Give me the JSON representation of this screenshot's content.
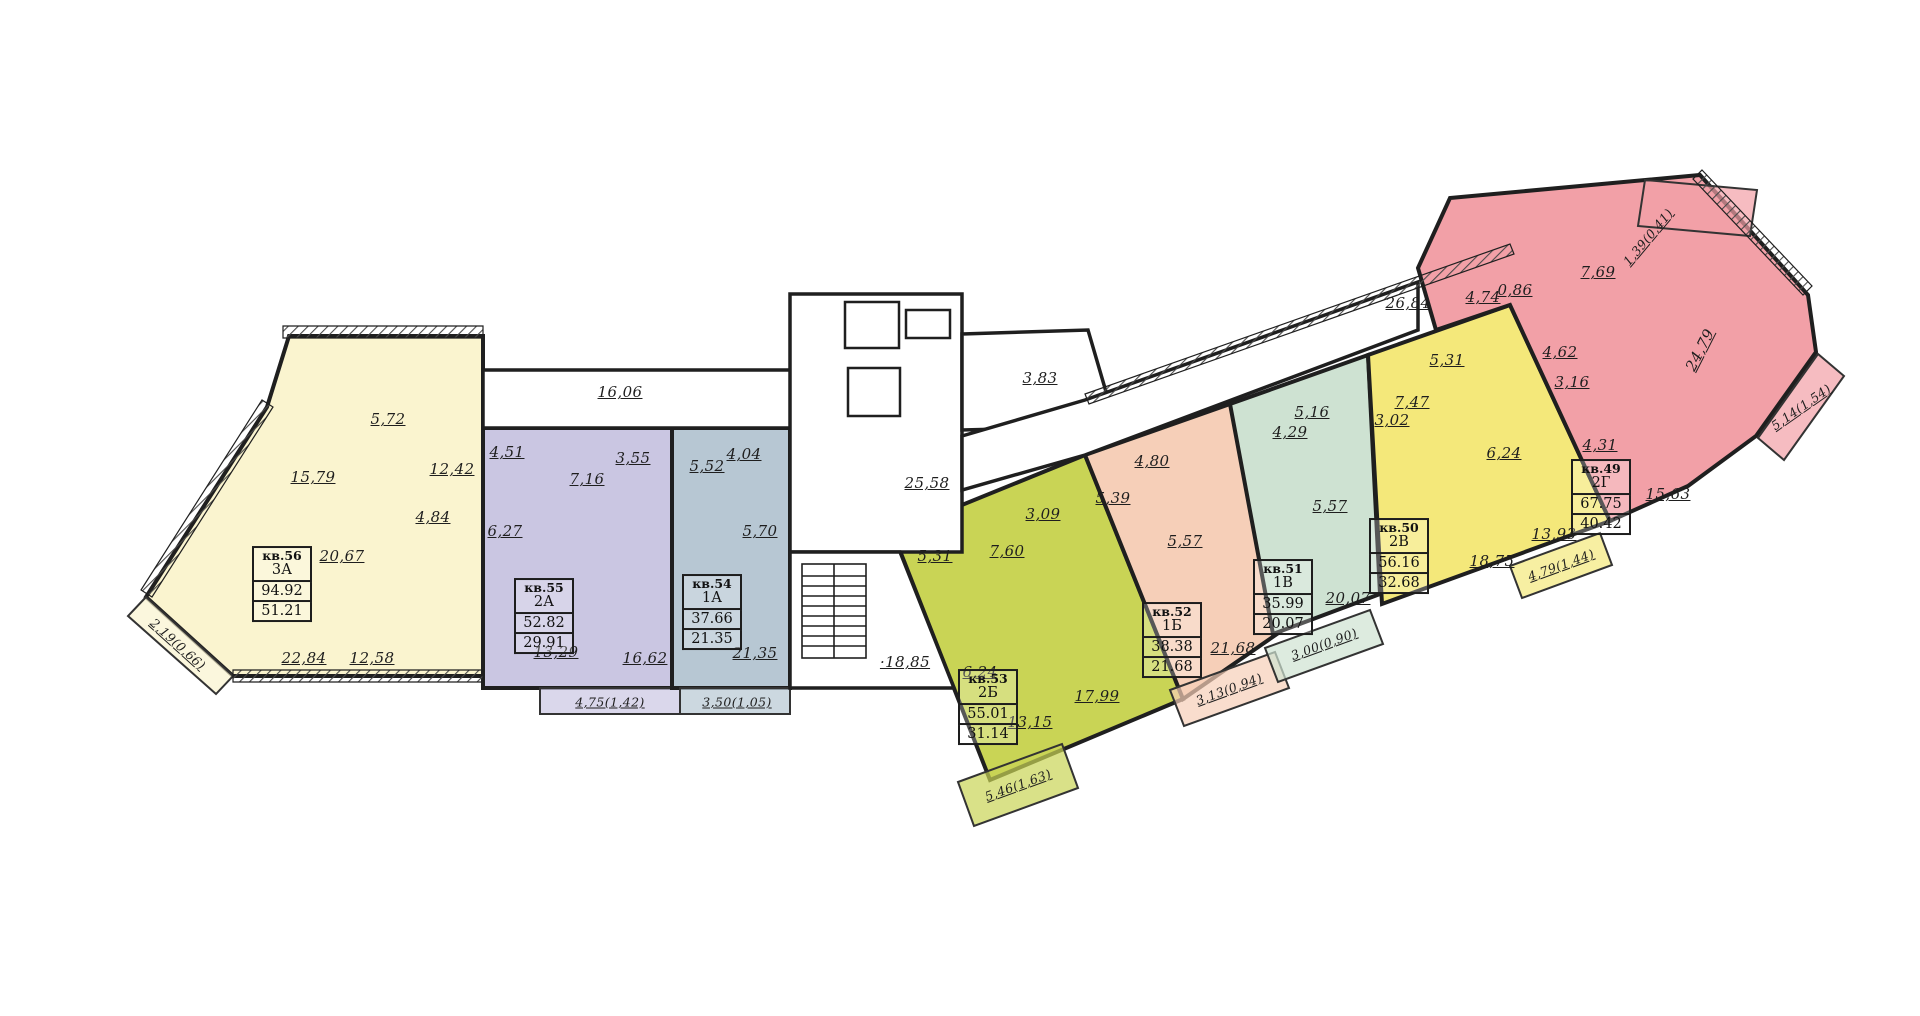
{
  "canvas": {
    "width": 1920,
    "height": 1016,
    "background": "#ffffff",
    "wall_color": "#1f1f1f",
    "hatch_color": "#4a4a4a"
  },
  "apartments": [
    {
      "id": "56",
      "number": "кв.56",
      "type": "3А",
      "total_area": "94.92",
      "living_area": "51.21",
      "color": "#faf4cf",
      "polygon": "289,336 483,336 483,676 233,676 146,597 267,407",
      "info_box": {
        "x": 282,
        "y": 584
      },
      "rooms": [
        {
          "label": "15,79",
          "x": 313,
          "y": 477
        },
        {
          "label": "5,72",
          "x": 388,
          "y": 419
        },
        {
          "label": "12,42",
          "x": 452,
          "y": 469
        },
        {
          "label": "4,84",
          "x": 433,
          "y": 517
        },
        {
          "label": "20,67",
          "x": 342,
          "y": 556
        },
        {
          "label": "22,84",
          "x": 304,
          "y": 658
        },
        {
          "label": "12,58",
          "x": 372,
          "y": 658
        }
      ],
      "balconies": [
        {
          "label": "2,19(0,66)",
          "x": 178,
          "y": 644,
          "rotate": 42
        }
      ],
      "balcony_polys": [
        "146,597 128,616 216,694 233,676"
      ]
    },
    {
      "id": "55",
      "number": "кв.55",
      "type": "2А",
      "total_area": "52.82",
      "living_area": "29.91",
      "color": "#cac6e2",
      "polygon": "483,428 672,428 672,688 483,688",
      "info_box": {
        "x": 544,
        "y": 616
      },
      "rooms": [
        {
          "label": "4,51",
          "x": 507,
          "y": 452
        },
        {
          "label": "7,16",
          "x": 587,
          "y": 479
        },
        {
          "label": "3,55",
          "x": 633,
          "y": 458
        },
        {
          "label": "6,27",
          "x": 505,
          "y": 531
        },
        {
          "label": "13,29",
          "x": 556,
          "y": 652
        },
        {
          "label": "16,62",
          "x": 645,
          "y": 658
        }
      ],
      "balconies": [
        {
          "label": "4,75(1,42)",
          "x": 610,
          "y": 702
        }
      ],
      "balcony_polys": [
        "540,688 680,688 680,714 540,714"
      ]
    },
    {
      "id": "54",
      "number": "кв.54",
      "type": "1А",
      "total_area": "37.66",
      "living_area": "21.35",
      "color": "#b7c7d3",
      "polygon": "672,428 790,428 790,688 672,688",
      "info_box": {
        "x": 712,
        "y": 612
      },
      "rooms": [
        {
          "label": "5,52",
          "x": 707,
          "y": 466
        },
        {
          "label": "4,04",
          "x": 744,
          "y": 454
        },
        {
          "label": "5,70",
          "x": 760,
          "y": 531
        },
        {
          "label": "21,35",
          "x": 755,
          "y": 653
        }
      ],
      "balconies": [
        {
          "label": "3,50(1,05)",
          "x": 737,
          "y": 702
        }
      ],
      "balcony_polys": [
        "680,688 790,688 790,714 680,714"
      ]
    },
    {
      "id": "53",
      "number": "кв.53",
      "type": "2Б",
      "total_area": "55.01",
      "living_area": "31.14",
      "color": "#c9d455",
      "polygon": "893,533 1085,455 1183,699 990,780",
      "info_box": {
        "x": 988,
        "y": 707
      },
      "rooms": [
        {
          "label": "5,31",
          "x": 935,
          "y": 556
        },
        {
          "label": "7,60",
          "x": 1007,
          "y": 551
        },
        {
          "label": "3,09",
          "x": 1043,
          "y": 514
        },
        {
          "label": "6,24",
          "x": 980,
          "y": 672
        },
        {
          "label": "13,15",
          "x": 1030,
          "y": 722
        },
        {
          "label": "17,99",
          "x": 1097,
          "y": 696
        }
      ],
      "balconies": [
        {
          "label": "5,46(1,63)",
          "x": 1018,
          "y": 785,
          "rotate": -20
        }
      ],
      "balcony_polys": [
        "958,782 1062,744 1078,788 974,826"
      ]
    },
    {
      "id": "52",
      "number": "кв.52",
      "type": "1Б",
      "total_area": "38.38",
      "living_area": "21.68",
      "color": "#f6cfb8",
      "polygon": "1085,455 1230,404 1290,625 1183,699",
      "info_box": {
        "x": 1172,
        "y": 640
      },
      "rooms": [
        {
          "label": "4,80",
          "x": 1152,
          "y": 461
        },
        {
          "label": "5,39",
          "x": 1113,
          "y": 498
        },
        {
          "label": "5,57",
          "x": 1185,
          "y": 541
        },
        {
          "label": "21,68",
          "x": 1233,
          "y": 648
        }
      ],
      "balconies": [
        {
          "label": "3,13(0,94)",
          "x": 1229,
          "y": 689,
          "rotate": -20
        }
      ],
      "balcony_polys": [
        "1170,690 1275,652 1289,688 1184,726"
      ]
    },
    {
      "id": "51",
      "number": "кв.51",
      "type": "1В",
      "total_area": "35.99",
      "living_area": "20.07",
      "color": "#cee2d2",
      "polygon": "1230,404 1368,355 1380,594 1273,634",
      "info_box": {
        "x": 1283,
        "y": 597
      },
      "rooms": [
        {
          "label": "4,29",
          "x": 1290,
          "y": 432
        },
        {
          "label": "5,16",
          "x": 1312,
          "y": 412
        },
        {
          "label": "5,57",
          "x": 1330,
          "y": 506
        },
        {
          "label": "20,07",
          "x": 1348,
          "y": 598
        }
      ],
      "balconies": [
        {
          "label": "3,00(0,90)",
          "x": 1324,
          "y": 644,
          "rotate": -20
        }
      ],
      "balcony_polys": [
        "1265,648 1370,610 1383,644 1278,682"
      ]
    },
    {
      "id": "50",
      "number": "кв.50",
      "type": "2В",
      "total_area": "56.16",
      "living_area": "32.68",
      "color": "#f4e87a",
      "polygon": "1368,355 1510,305 1610,521 1382,604",
      "info_box": {
        "x": 1399,
        "y": 556
      },
      "rooms": [
        {
          "label": "5,31",
          "x": 1447,
          "y": 360
        },
        {
          "label": "7,47",
          "x": 1412,
          "y": 402
        },
        {
          "label": "3,02",
          "x": 1392,
          "y": 420
        },
        {
          "label": "6,24",
          "x": 1504,
          "y": 453
        },
        {
          "label": "18,75",
          "x": 1492,
          "y": 561
        },
        {
          "label": "13,93",
          "x": 1554,
          "y": 534
        }
      ],
      "balconies": [
        {
          "label": "4,79(1,44)",
          "x": 1561,
          "y": 565,
          "rotate": -20
        }
      ],
      "balcony_polys": [
        "1510,566 1600,533 1612,565 1522,598"
      ]
    },
    {
      "id": "49",
      "number": "кв.49",
      "type": "2Г",
      "total_area": "67.75",
      "living_area": "40.42",
      "color": "#f2a0a7",
      "polygon": "1418,268 1450,198 1700,175 1808,295 1816,352 1756,436 1688,486 1610,521 1510,305 1436,330",
      "info_box": {
        "x": 1601,
        "y": 497
      },
      "rooms": [
        {
          "label": "4,74",
          "x": 1483,
          "y": 297
        },
        {
          "label": "0,86",
          "x": 1515,
          "y": 290
        },
        {
          "label": "7,69",
          "x": 1598,
          "y": 272
        },
        {
          "label": "4,62",
          "x": 1560,
          "y": 352
        },
        {
          "label": "3,16",
          "x": 1572,
          "y": 382
        },
        {
          "label": "4,31",
          "x": 1600,
          "y": 445
        },
        {
          "label": "24,79",
          "x": 1700,
          "y": 350,
          "rotate": -63
        },
        {
          "label": "15,63",
          "x": 1668,
          "y": 494
        }
      ],
      "balconies": [
        {
          "label": "1,39(0,41)",
          "x": 1648,
          "y": 237,
          "rotate": -50
        },
        {
          "label": "5,14(1,54)",
          "x": 1801,
          "y": 407,
          "rotate": -35
        }
      ],
      "balcony_polys": [
        "1645,180 1757,190 1750,236 1638,226",
        "1758,438 1818,354 1844,376 1784,460"
      ]
    }
  ],
  "common_labels": [
    {
      "label": "16,06",
      "x": 620,
      "y": 392
    },
    {
      "label": "25,58",
      "x": 927,
      "y": 483
    },
    {
      "label": "3,83",
      "x": 1040,
      "y": 378
    },
    {
      "label": "26,84",
      "x": 1408,
      "y": 303
    },
    {
      "label": "18,85",
      "x": 905,
      "y": 662,
      "dot": true
    }
  ]
}
